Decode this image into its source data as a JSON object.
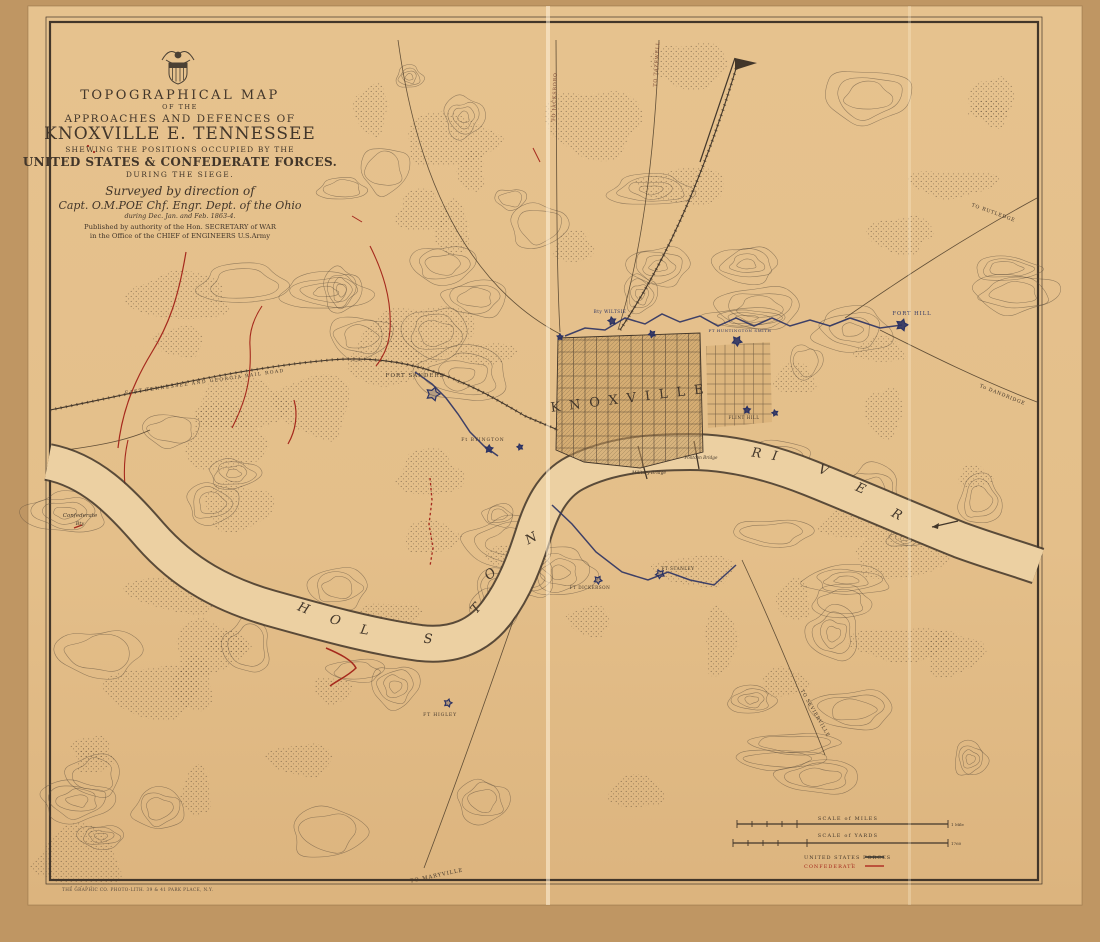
{
  "title_block": {
    "l1": "TOPOGRAPHICAL MAP",
    "l2": "OF THE",
    "l3": "APPROACHES AND DEFENCES OF",
    "l4": "KNOXVILLE E. TENNESSEE",
    "l5": "SHEWING THE POSITIONS OCCUPIED BY THE",
    "l6": "UNITED STATES & CONFEDERATE FORCES.",
    "l7": "DURING THE SIEGE.",
    "l8": "Surveyed by direction of",
    "l9": "Capt. O.M.POE Chf. Engr. Dept. of the Ohio",
    "l10": "during Dec. Jan. and Feb. 1863-4.",
    "l11": "Published by authority of the Hon. SECRETARY of WAR",
    "l12": "in the Office of the CHIEF of ENGINEERS U.S.Army"
  },
  "scales": {
    "miles_caption": "SCALE of MILES",
    "miles_end": "1 Mile",
    "yards_caption": "SCALE of YARDS",
    "yards_end": "1760"
  },
  "legend": {
    "us": "UNITED STATES FORCES",
    "conf": "CONFEDERATE",
    "ditto": "″"
  },
  "imprint": "THE GRAPHIC CO. PHOTO-LITH. 39 & 41 PARK PLACE, N.Y.",
  "colors": {
    "backdrop": "#bf9663",
    "paper": "#e4bf8a",
    "paper_light": "#eccf9f",
    "ink": "#42362a",
    "ink_faint": "#5d4f3d",
    "red": "#a5291d",
    "blue": "#2b3263",
    "road": "#7c4a34",
    "fold": "#fff3da"
  },
  "map_labels": [
    {
      "t": "H",
      "x": 302,
      "y": 612,
      "r": 22,
      "s": 13,
      "c": "ink",
      "i": true
    },
    {
      "t": "O",
      "x": 334,
      "y": 624,
      "r": 18,
      "s": 13,
      "c": "ink",
      "i": true
    },
    {
      "t": "L",
      "x": 364,
      "y": 634,
      "r": 10,
      "s": 13,
      "c": "ink",
      "i": true
    },
    {
      "t": "S",
      "x": 428,
      "y": 643,
      "r": 2,
      "s": 13,
      "c": "ink",
      "i": true
    },
    {
      "t": "T",
      "x": 479,
      "y": 611,
      "r": -50,
      "s": 13,
      "c": "ink",
      "i": true
    },
    {
      "t": "O",
      "x": 493,
      "y": 577,
      "r": -42,
      "s": 13,
      "c": "ink",
      "i": true
    },
    {
      "t": "N",
      "x": 533,
      "y": 542,
      "r": -28,
      "s": 13,
      "c": "ink",
      "i": true
    },
    {
      "t": "R",
      "x": 756,
      "y": 457,
      "r": 8,
      "s": 13,
      "c": "ink",
      "i": true
    },
    {
      "t": "I",
      "x": 774,
      "y": 460,
      "r": 10,
      "s": 13,
      "c": "ink",
      "i": true
    },
    {
      "t": "V",
      "x": 822,
      "y": 474,
      "r": 20,
      "s": 13,
      "c": "ink",
      "i": true
    },
    {
      "t": "E",
      "x": 859,
      "y": 492,
      "r": 24,
      "s": 13,
      "c": "ink",
      "i": true
    },
    {
      "t": "R",
      "x": 895,
      "y": 518,
      "r": 28,
      "s": 13,
      "c": "ink",
      "i": true
    },
    {
      "t": "KNOXVILLE",
      "x": 632,
      "y": 402,
      "r": -7,
      "s": 13,
      "c": "ink",
      "ls": 9
    },
    {
      "t": "FORT SANDERS",
      "x": 415,
      "y": 377,
      "r": 0,
      "s": 5.5,
      "c": "ink",
      "ls": 1
    },
    {
      "t": "Ft BYINGTON",
      "x": 483,
      "y": 441,
      "r": 0,
      "s": 4.5,
      "c": "ink",
      "ls": 1
    },
    {
      "t": "FORT HILL",
      "x": 912,
      "y": 315,
      "r": 0,
      "s": 5.2,
      "c": "blue",
      "ls": 1
    },
    {
      "t": "Bty WILTSIE",
      "x": 610,
      "y": 313,
      "r": 0,
      "s": 4.2,
      "c": "blue",
      "ls": 0.5
    },
    {
      "t": "FT HUNTINGTON SMITH",
      "x": 740,
      "y": 332,
      "r": 0,
      "s": 4,
      "c": "blue",
      "ls": 0.5
    },
    {
      "t": "FLINT HILL",
      "x": 744,
      "y": 419,
      "r": 0,
      "s": 4.2,
      "c": "ink",
      "ls": 0.5
    },
    {
      "t": "FT STANLEY",
      "x": 678,
      "y": 570,
      "r": 0,
      "s": 4.2,
      "c": "ink",
      "ls": 0.5
    },
    {
      "t": "FT DICKERSON",
      "x": 590,
      "y": 589,
      "r": 0,
      "s": 4.2,
      "c": "ink",
      "ls": 0.5
    },
    {
      "t": "FT HIGLEY",
      "x": 440,
      "y": 716,
      "r": 0,
      "s": 4.6,
      "c": "ink",
      "ls": 0.8
    },
    {
      "t": "TO JACKSBORO",
      "x": 556,
      "y": 97,
      "r": -88,
      "s": 4.8,
      "c": "road",
      "ls": 0.8
    },
    {
      "t": "TO TAZEWELL",
      "x": 658,
      "y": 64,
      "r": -86,
      "s": 4.8,
      "c": "road",
      "ls": 0.8
    },
    {
      "t": "TO RUTLEDGE",
      "x": 993,
      "y": 214,
      "r": 20,
      "s": 4.8,
      "c": "ink",
      "ls": 0.8
    },
    {
      "t": "To DANDRIDGE",
      "x": 1002,
      "y": 396,
      "r": 22,
      "s": 4.8,
      "c": "ink",
      "ls": 0.8
    },
    {
      "t": "TO SEVIERVILLE",
      "x": 814,
      "y": 714,
      "r": 60,
      "s": 4.8,
      "c": "ink",
      "ls": 0.8
    },
    {
      "t": "TO MARYVILLE",
      "x": 437,
      "y": 877,
      "r": -12,
      "s": 5.2,
      "c": "ink",
      "ls": 1
    },
    {
      "t": "EAST TENNESSEE AND GEORGIA RAIL ROAD",
      "x": 205,
      "y": 383,
      "r": -8,
      "s": 4.6,
      "c": "ink",
      "ls": 1.4
    },
    {
      "t": "Confederate",
      "x": 80,
      "y": 517,
      "r": 0,
      "s": 5.5,
      "c": "ink",
      "i": true
    },
    {
      "t": "Bty",
      "x": 80,
      "y": 525,
      "r": 0,
      "s": 5,
      "c": "ink",
      "i": true
    },
    {
      "t": "Military Bridge",
      "x": 649,
      "y": 474,
      "r": 0,
      "s": 4.4,
      "c": "ink",
      "i": true
    },
    {
      "t": "Pontoon Bridge",
      "x": 701,
      "y": 459,
      "r": 0,
      "s": 4.2,
      "c": "ink",
      "i": true
    }
  ],
  "fort_markers": [
    {
      "x": 433,
      "y": 394,
      "r": 7,
      "f": false
    },
    {
      "x": 489,
      "y": 449,
      "r": 4,
      "f": true
    },
    {
      "x": 612,
      "y": 321,
      "r": 4,
      "f": true
    },
    {
      "x": 652,
      "y": 334,
      "r": 3.5,
      "f": true
    },
    {
      "x": 737,
      "y": 341,
      "r": 5,
      "f": true
    },
    {
      "x": 902,
      "y": 325,
      "r": 6,
      "f": true
    },
    {
      "x": 747,
      "y": 410,
      "r": 3.5,
      "f": true
    },
    {
      "x": 775,
      "y": 413,
      "r": 3,
      "f": true
    },
    {
      "x": 660,
      "y": 574,
      "r": 4.5,
      "f": false
    },
    {
      "x": 598,
      "y": 580,
      "r": 4,
      "f": false
    },
    {
      "x": 448,
      "y": 703,
      "r": 4,
      "f": false
    },
    {
      "x": 560,
      "y": 337,
      "r": 3,
      "f": true
    },
    {
      "x": 520,
      "y": 447,
      "r": 3,
      "f": true
    }
  ]
}
